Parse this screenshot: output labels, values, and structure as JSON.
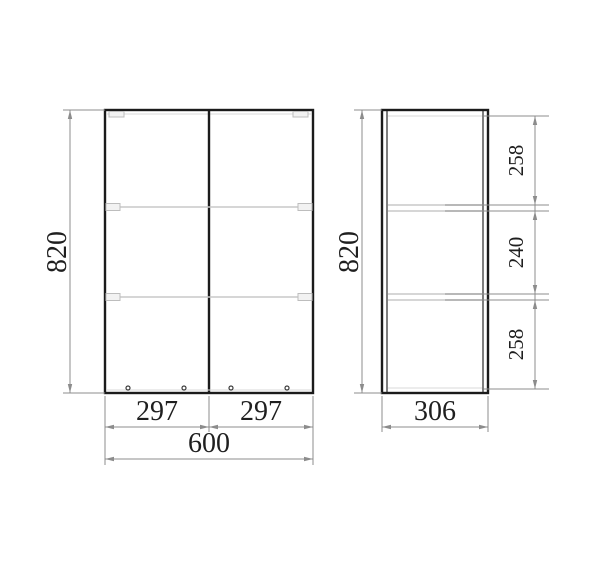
{
  "drawing": {
    "type": "cabinet-dimension-drawing",
    "views": {
      "front": {
        "height": "820",
        "door_widths": [
          "297",
          "297"
        ],
        "total_width": "600"
      },
      "side": {
        "height": "820",
        "depth": "306",
        "shelf_sections": [
          "258",
          "240",
          "258"
        ]
      }
    },
    "colors": {
      "background": "#ffffff",
      "outline": "#1b1b1b",
      "thin_detail": "#c9c9c9",
      "dimension_lines": "#8c8c8c",
      "text": "#1f1f1f"
    }
  }
}
